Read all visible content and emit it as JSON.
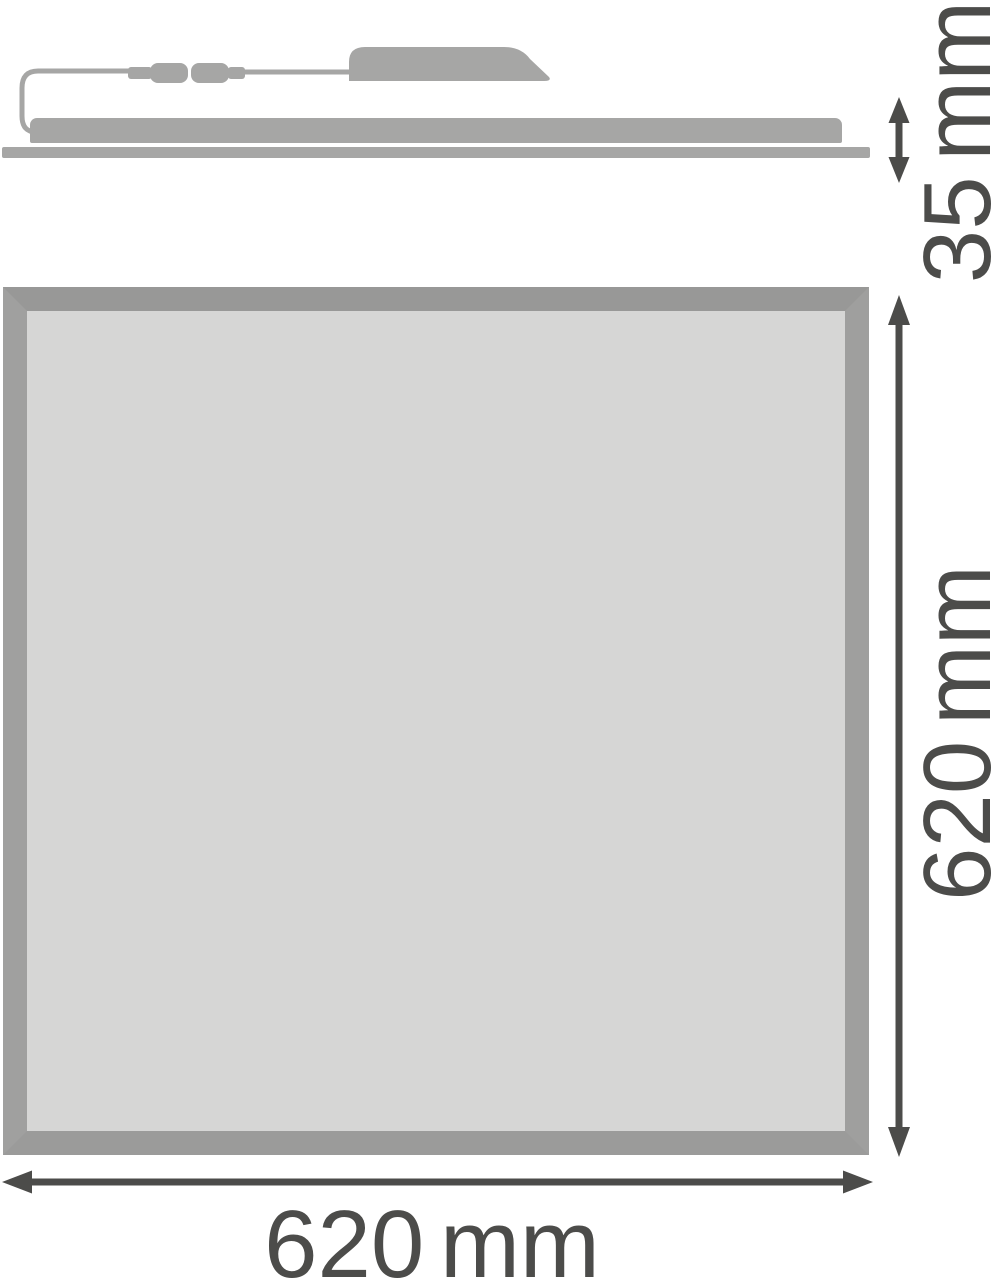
{
  "drawing": {
    "title": "LED panel luminaire dimension drawing",
    "views": {
      "side_profile": {
        "parts": [
          "power-cable-loop",
          "cable-connector",
          "driver-box",
          "panel-profile",
          "panel-face"
        ]
      },
      "front": {
        "parts": [
          "panel-frame",
          "panel-diffuser"
        ]
      }
    }
  },
  "dimensions": {
    "side_height": {
      "label": "35 mm",
      "value": 35,
      "unit": "mm"
    },
    "front_height": {
      "label": "620 mm",
      "value": 620,
      "unit": "mm"
    },
    "front_width": {
      "label": "620 mm",
      "value": 620,
      "unit": "mm"
    }
  },
  "colors": {
    "background": "#ffffff",
    "shape_gray": "#a6a6a5",
    "panel_frame_gray": "#9c9c9b",
    "panel_fill_gray": "#d6d6d5",
    "dimension_ink": "#4c4c4a"
  }
}
